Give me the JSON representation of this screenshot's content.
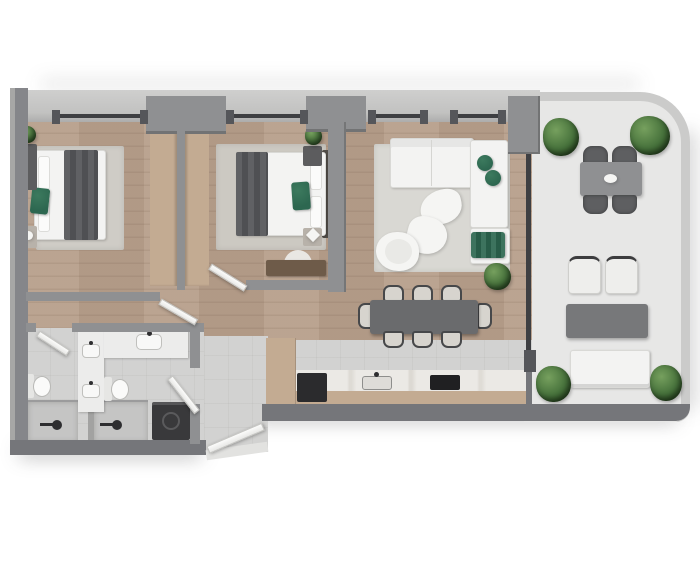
{
  "meta": {
    "kind": "rendered-floor-plan",
    "view": "top-down",
    "units": "pixels",
    "canvas": {
      "width": 700,
      "height": 566
    }
  },
  "palette": {
    "wood": "#b79f8b",
    "tile": "#d2d2d1",
    "terrace": "#e7e7e6",
    "parapet": "#cbcbca",
    "wallDark": "#75767a",
    "wallMid": "#8f9092",
    "wallLight": "#c2c2c1",
    "wallPost": "#55565a",
    "glass": "#3e3f42",
    "softWhite": "#f3f3f2",
    "green": "#2d6750",
    "blanket": "#56575a",
    "darkFurn": "#39393b",
    "tan": "#c3ab92",
    "tableGray": "#6a6b6d",
    "outTable": "#8f9092",
    "outCoffee": "#77787a"
  },
  "rooms": [
    {
      "name": "bedroom-1",
      "furniture": [
        "double-bed",
        "dark-blanket",
        "green-throw",
        "area-rug",
        "built-in-wardrobe",
        "dresser",
        "nightstand",
        "ball-lamp",
        "potted-plant"
      ]
    },
    {
      "name": "bedroom-2",
      "furniture": [
        "double-bed",
        "dark-blanket",
        "green-throw",
        "area-rug",
        "built-in-wardrobe",
        "nightstand-with-plant",
        "nightstand-with-lamp",
        "half-moon-rug",
        "foot-bench"
      ]
    },
    {
      "name": "living-room",
      "furniture": [
        "l-shaped-sofa",
        "green-cushions",
        "ottoman-with-green-throw",
        "organic-coffee-tables",
        "round-armchair",
        "area-rug",
        "potted-plant"
      ]
    },
    {
      "name": "dining-area",
      "furniture": [
        "rectangular-dining-table",
        "eight-dining-chairs"
      ]
    },
    {
      "name": "kitchen",
      "furniture": [
        "counter-run",
        "dark-basin",
        "sink",
        "cooktop",
        "tall-cabinet-column"
      ]
    },
    {
      "name": "bathroom-1",
      "furniture": [
        "vanity-with-sink",
        "toilet",
        "walk-in-shower"
      ]
    },
    {
      "name": "bathroom-2",
      "furniture": [
        "vanity-with-sink",
        "toilet",
        "walk-in-shower",
        "washing-machine"
      ]
    },
    {
      "name": "entry-hall",
      "furniture": [
        "entrance-door",
        "threshold-step"
      ]
    },
    {
      "name": "terrace",
      "furniture": [
        "outdoor-dining-table",
        "four-outdoor-chairs",
        "two-lounge-chairs",
        "outdoor-coffee-table",
        "outdoor-sofa",
        "four-planters"
      ]
    }
  ],
  "openings": [
    "bedroom-1-window",
    "bedroom-2-window",
    "living-window-a",
    "living-window-b",
    "terrace-sliding-glass",
    "bedroom-1-door",
    "bedroom-2-door",
    "bathroom-1-door",
    "bathroom-2-door",
    "entrance-door"
  ]
}
